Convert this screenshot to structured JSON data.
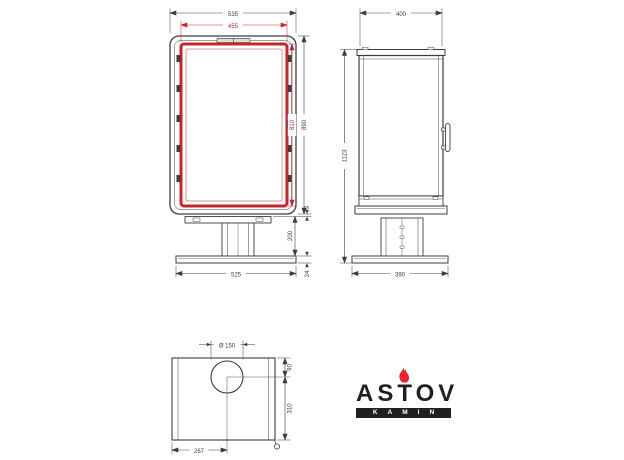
{
  "colors": {
    "line": "#3d3d3d",
    "dimension_red": "#c1272d",
    "logo_black": "#231f20",
    "flame_red": "#e8262d"
  },
  "front_view": {
    "overall_width": "535",
    "door_width": "455",
    "overall_height": "890",
    "door_height": "810",
    "body_to_pedestal_gap": "9",
    "pedestal_height": "200",
    "base_thickness": "24",
    "base_width": "525"
  },
  "side_view": {
    "depth": "400",
    "total_height": "1123",
    "base_depth": "390"
  },
  "top_view": {
    "flue_diameter": "Ø 150",
    "flue_center_from_left": "267",
    "flue_center_from_back": "90",
    "flue_center_to_front": "310"
  },
  "logo": {
    "brand": "ASTOV",
    "tagline": "KAMIN"
  }
}
